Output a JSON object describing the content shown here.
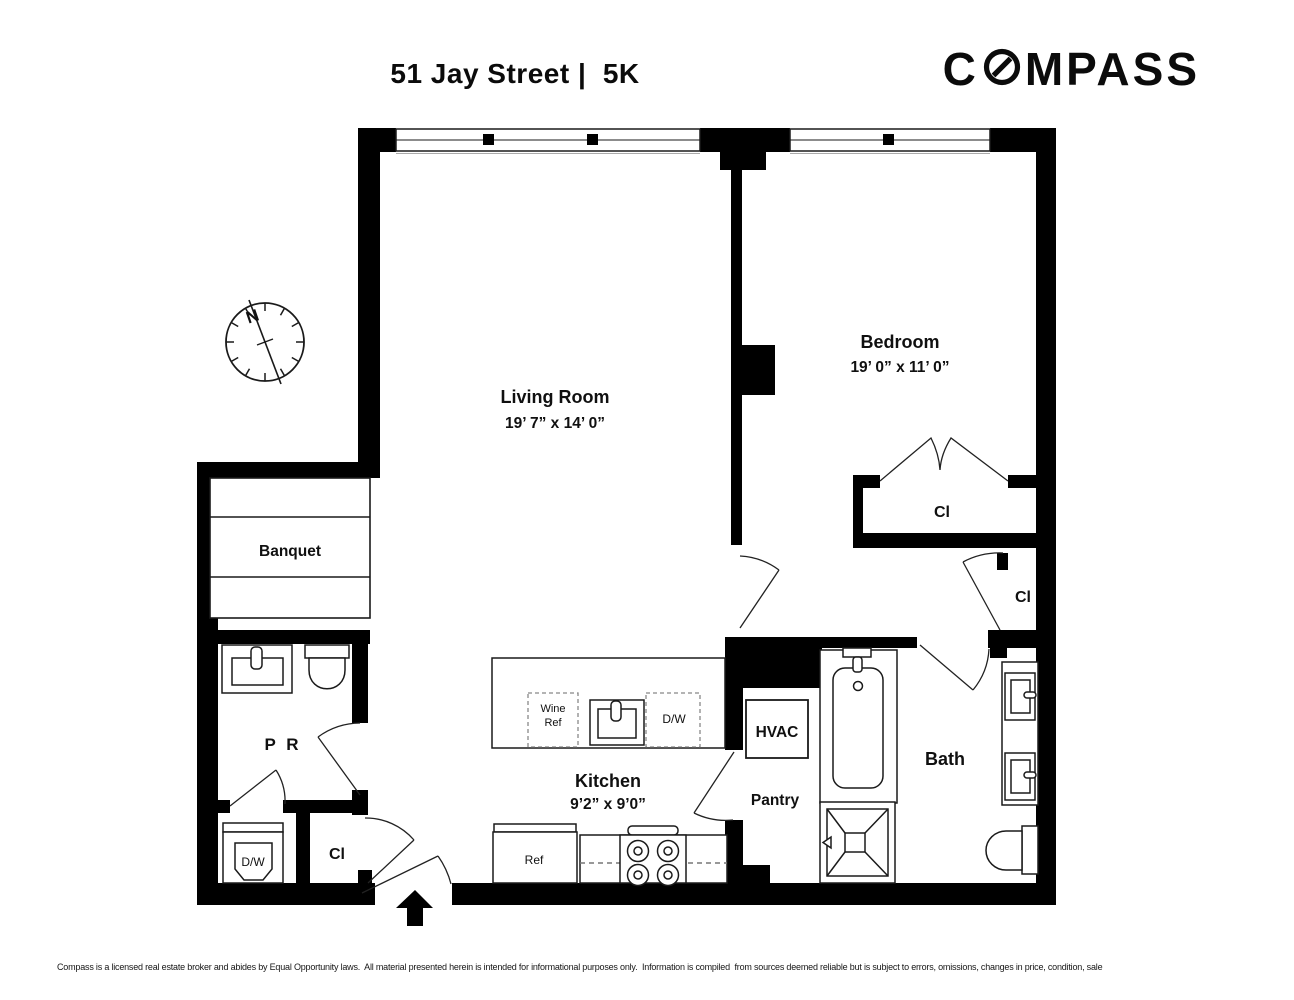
{
  "header": {
    "title": "51 Jay Street |  5K",
    "logo_prefix": "C",
    "logo_suffix": "MPASS"
  },
  "rooms": {
    "living_room": {
      "name": "Living Room",
      "dims": "19’ 7” x 14’ 0”"
    },
    "bedroom": {
      "name": "Bedroom",
      "dims": "19’ 0” x 11’ 0”"
    },
    "kitchen": {
      "name": "Kitchen",
      "dims": "9’2” x 9’0”"
    },
    "bath": {
      "name": "Bath"
    },
    "banquet": {
      "name": "Banquet"
    },
    "powder_room": {
      "name": "P R"
    },
    "pantry": {
      "name": "Pantry"
    },
    "closet_bedroom": {
      "name": "Cl"
    },
    "closet_hall": {
      "name": "Cl"
    },
    "closet_entry": {
      "name": "Cl"
    }
  },
  "fixtures": {
    "hvac": "HVAC",
    "wine_ref_line1": "Wine",
    "wine_ref_line2": "Ref",
    "island_dishwasher": "D/W",
    "refrigerator": "Ref",
    "washer_dryer": "D/W"
  },
  "compass_rose": {
    "north": "N"
  },
  "footer": {
    "line1": "Compass is a licensed real estate broker and abides by Equal Opportunity laws.  All material presented herein is intended for informational purposes only.  Information is compiled  from sources deemed reliable but is subject to errors, omissions, changes in price, condition, sale",
    "line2": "or withdraw without notice.  No statement is made as to accuracy of any description.  All measurements and square footages are approximate.  Exact dimensions can be obtained by retaining the services of an architect or engineer.  This is not intended to solicit property already listed."
  },
  "colors": {
    "wall": "#000000",
    "background": "#ffffff",
    "fixture_line": "#1a1a1a"
  }
}
